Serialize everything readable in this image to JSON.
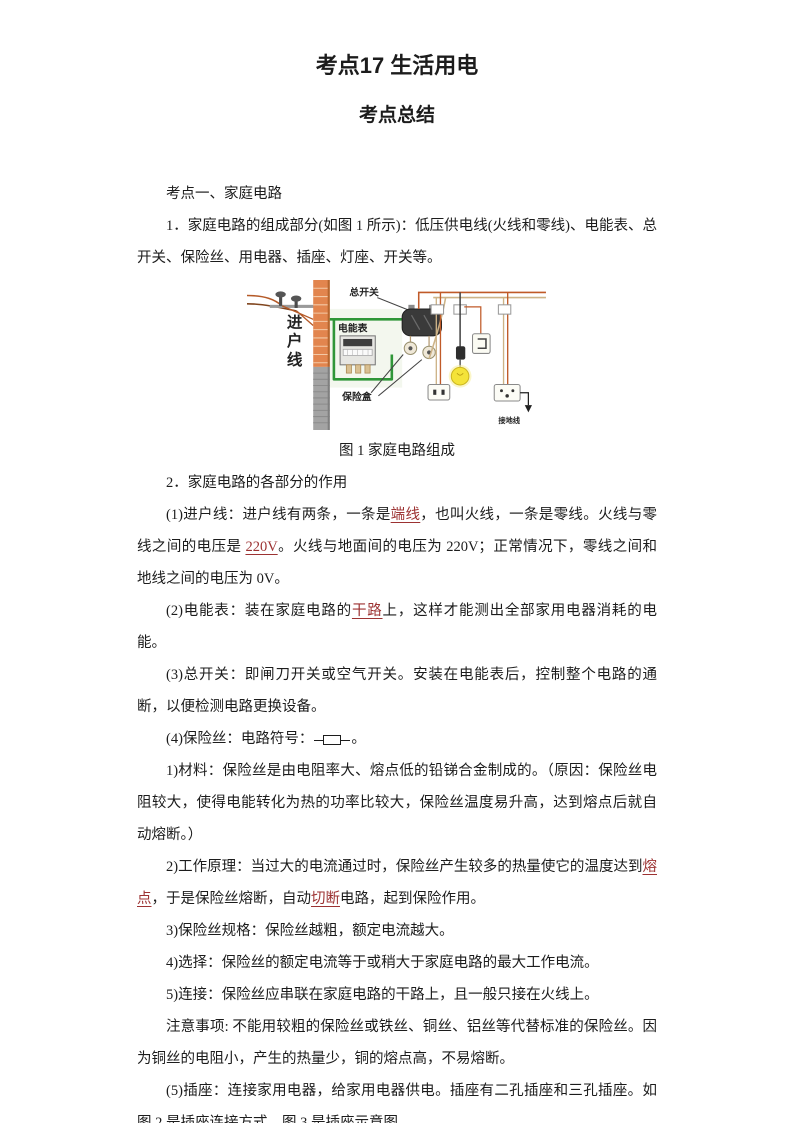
{
  "page": {
    "title": "考点17 生活用电",
    "subtitle": "考点总结"
  },
  "figure": {
    "caption": "图 1 家庭电路组成",
    "labels": {
      "incoming_line": "进户线",
      "main_switch": "总开关",
      "energy_meter": "电能表",
      "fuse_box": "保险盒",
      "ground_wire": "接地线"
    },
    "colors": {
      "wall_brick": "#e2854e",
      "wall_concrete": "#a3a3a3",
      "meter_loop_wire": "#2f9638",
      "live_wire": "#c05a28",
      "neutral_wire": "#cdb387",
      "bulb": "#f4e339"
    }
  },
  "content": {
    "highlight_color": "#9c3232",
    "before_figure": [
      {
        "segments": [
          {
            "text": "考点一、家庭电路"
          }
        ]
      },
      {
        "segments": [
          {
            "text": "1．家庭电路的组成部分(如图 1 所示)：低压供电线(火线和零线)、电能表、总开关、保险丝、用电器、插座、灯座、开关等。"
          }
        ]
      }
    ],
    "after_figure": [
      {
        "segments": [
          {
            "text": "2．家庭电路的各部分的作用"
          }
        ]
      },
      {
        "segments": [
          {
            "text": "(1)进户线：进户线有两条，一条是"
          },
          {
            "text": "端线",
            "red": true
          },
          {
            "text": "，也叫火线，一条是零线。火线与零线之间的电压是 "
          },
          {
            "text": "220V",
            "red": true
          },
          {
            "text": "。火线与地面间的电压为 220V；正常情况下，零线之间和地线之间的电压为 0V。"
          }
        ]
      },
      {
        "segments": [
          {
            "text": "(2)电能表：装在家庭电路的"
          },
          {
            "text": "干路",
            "red": true
          },
          {
            "text": "上，这样才能测出全部家用电器消耗的电能。"
          }
        ]
      },
      {
        "segments": [
          {
            "text": "(3)总开关：即闸刀开关或空气开关。安装在电能表后，控制整个电路的通断，以便检测电路更换设备。"
          }
        ]
      },
      {
        "segments": [
          {
            "text": "(4)保险丝：电路符号："
          },
          {
            "symbol": "fuse"
          },
          {
            "text": "。"
          }
        ]
      },
      {
        "segments": [
          {
            "text": "1)材料：保险丝是由电阻率大、熔点低的铅锑合金制成的。（原因：保险丝电阻较大，使得电能转化为热的功率比较大，保险丝温度易升高，达到熔点后就自动熔断。）"
          }
        ]
      },
      {
        "segments": [
          {
            "text": "2)工作原理：当过大的电流通过时，保险丝产生较多的热量使它的温度达到"
          },
          {
            "text": "熔点",
            "red": true
          },
          {
            "text": "，于是保险丝熔断，自动"
          },
          {
            "text": "切断",
            "red": true
          },
          {
            "text": "电路，起到保险作用。"
          }
        ]
      },
      {
        "segments": [
          {
            "text": "3)保险丝规格：保险丝越粗，额定电流越大。"
          }
        ]
      },
      {
        "segments": [
          {
            "text": "4)选择：保险丝的额定电流等于或稍大于家庭电路的最大工作电流。"
          }
        ]
      },
      {
        "segments": [
          {
            "text": "5)连接：保险丝应串联在家庭电路的干路上，且一般只接在火线上。"
          }
        ]
      },
      {
        "segments": [
          {
            "text": "注意事项: 不能用较粗的保险丝或铁丝、铜丝、铝丝等代替标准的保险丝。因为铜丝的电阻小，产生的热量少，铜的熔点高，不易熔断。"
          }
        ]
      },
      {
        "segments": [
          {
            "text": "(5)插座：连接家用电器，给家用电器供电。插座有二孔插座和三孔插座。如图 2 是插座连接方式、图 3 是插座示意图。"
          }
        ]
      }
    ]
  }
}
